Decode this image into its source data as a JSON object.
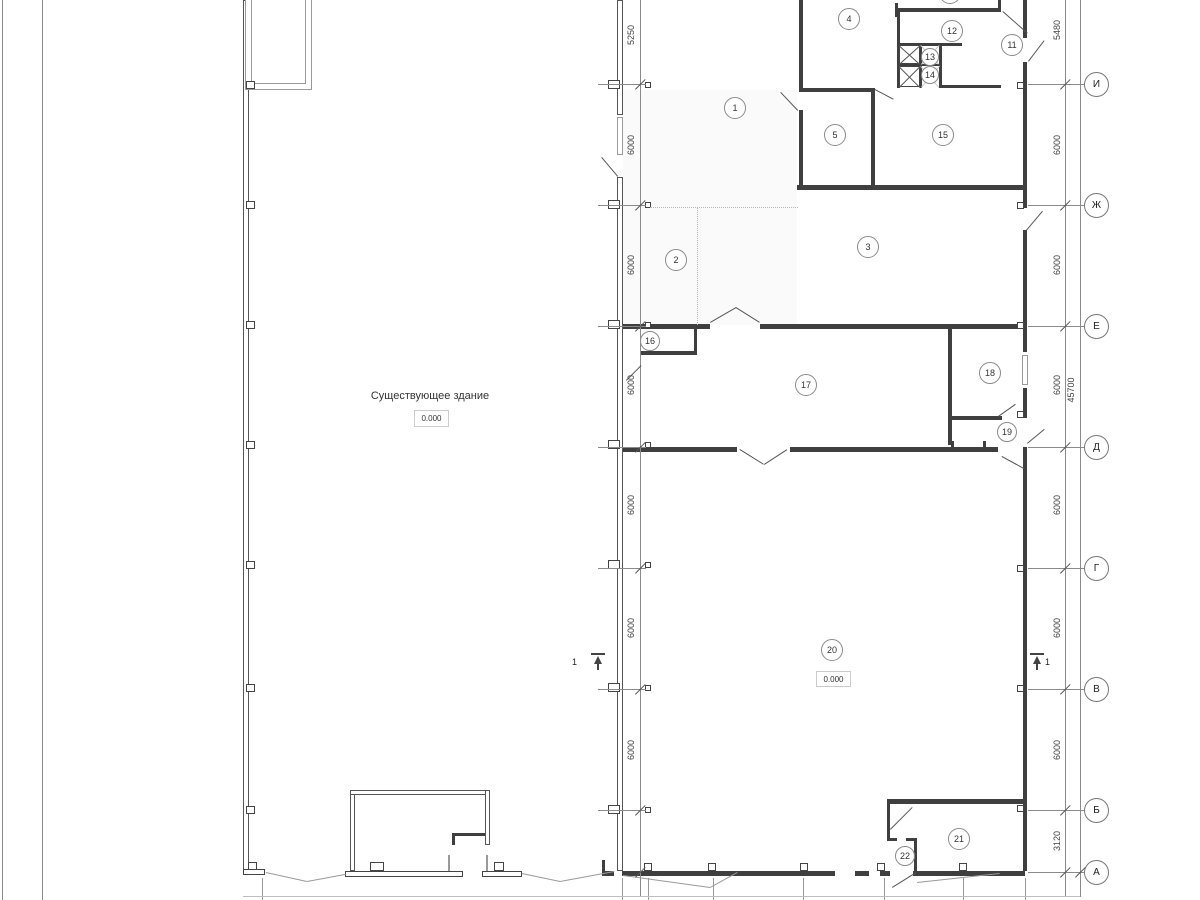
{
  "building": {
    "existing_label": "Существующее здание",
    "existing_level": "0.000",
    "new_level": "0.000"
  },
  "rooms": [
    {
      "n": "1",
      "x": 735,
      "y": 108
    },
    {
      "n": "2",
      "x": 676,
      "y": 260
    },
    {
      "n": "3",
      "x": 868,
      "y": 247
    },
    {
      "n": "4",
      "x": 849,
      "y": 19
    },
    {
      "n": "5",
      "x": 835,
      "y": 135
    },
    {
      "n": "",
      "x": 950,
      "y": -7
    },
    {
      "n": "11",
      "x": 1012,
      "y": 45
    },
    {
      "n": "12",
      "x": 952,
      "y": 31
    },
    {
      "n": "13",
      "x": 930,
      "y": 57,
      "r": 9
    },
    {
      "n": "14",
      "x": 930,
      "y": 75,
      "r": 9
    },
    {
      "n": "15",
      "x": 943,
      "y": 135
    },
    {
      "n": "16",
      "x": 650,
      "y": 341,
      "r": 10
    },
    {
      "n": "17",
      "x": 806,
      "y": 385
    },
    {
      "n": "18",
      "x": 990,
      "y": 373
    },
    {
      "n": "19",
      "x": 1007,
      "y": 432,
      "r": 10
    },
    {
      "n": "20",
      "x": 832,
      "y": 650
    },
    {
      "n": "21",
      "x": 959,
      "y": 839
    },
    {
      "n": "22",
      "x": 905,
      "y": 856,
      "r": 10
    }
  ],
  "axes": [
    {
      "label": "И",
      "y": 84
    },
    {
      "label": "Ж",
      "y": 205
    },
    {
      "label": "Е",
      "y": 326
    },
    {
      "label": "Д",
      "y": 447
    },
    {
      "label": "Г",
      "y": 568
    },
    {
      "label": "В",
      "y": 689
    },
    {
      "label": "Б",
      "y": 810
    },
    {
      "label": "А",
      "y": 872
    }
  ],
  "dims_left": [
    {
      "text": "5250",
      "y": 35
    },
    {
      "text": "6000",
      "y": 145
    },
    {
      "text": "6000",
      "y": 265
    },
    {
      "text": "6000",
      "y": 385
    },
    {
      "text": "6000",
      "y": 505
    },
    {
      "text": "6000",
      "y": 628
    },
    {
      "text": "6000",
      "y": 750
    }
  ],
  "dims_right": [
    {
      "text": "5480",
      "y": 30
    },
    {
      "text": "6000",
      "y": 145
    },
    {
      "text": "6000",
      "y": 265
    },
    {
      "text": "6000",
      "y": 385
    },
    {
      "text": "6000",
      "y": 505
    },
    {
      "text": "6000",
      "y": 628
    },
    {
      "text": "6000",
      "y": 750
    },
    {
      "text": "3120",
      "y": 841
    }
  ],
  "dim_overall": {
    "text": "45700",
    "x": 1071,
    "y": 390
  },
  "section_markers": [
    {
      "label": "1",
      "x": 598,
      "side": "left"
    },
    {
      "label": "1",
      "x": 1037,
      "side": "right"
    }
  ]
}
